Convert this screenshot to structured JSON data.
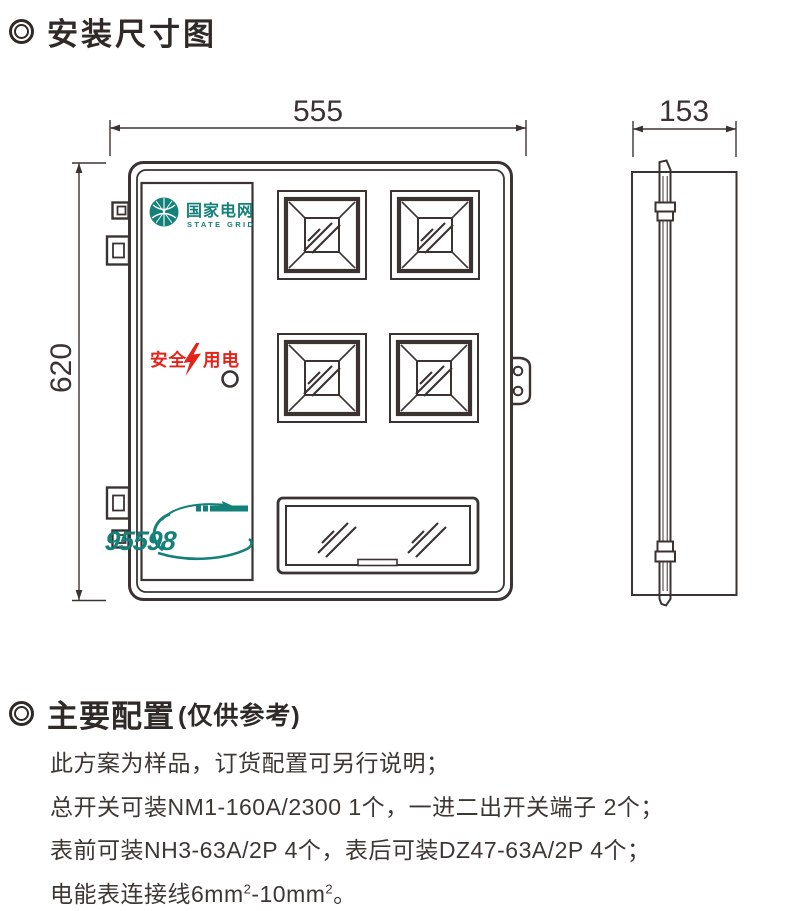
{
  "sections": {
    "dimensions_title": "安装尺寸图",
    "config_title": "主要配置",
    "config_note": "(仅供参考)"
  },
  "diagram": {
    "width_label": "555",
    "height_label": "620",
    "depth_label": "153",
    "logo": {
      "zh": "国家电网",
      "en": "STATE GRID"
    },
    "safety": {
      "left": "安全",
      "right": "用电"
    },
    "hotline": "95598"
  },
  "config": {
    "line1": "此方案为样品，订货配置可另行说明；",
    "line2": "总开关可装NM1-160A/2300 1个，一进二出开关端子 2个；",
    "line3": "表前可装NH3-63A/2P 4个，表后可装DZ47-63A/2P 4个；",
    "line4": {
      "p1": "电能表连接线6mm",
      "sup1": "2",
      "p2": "-10mm",
      "sup2": "2",
      "p3": "。"
    }
  },
  "colors": {
    "line": "#3b3331",
    "brand_teal": "#14807a",
    "safety_red": "#e5231b"
  }
}
